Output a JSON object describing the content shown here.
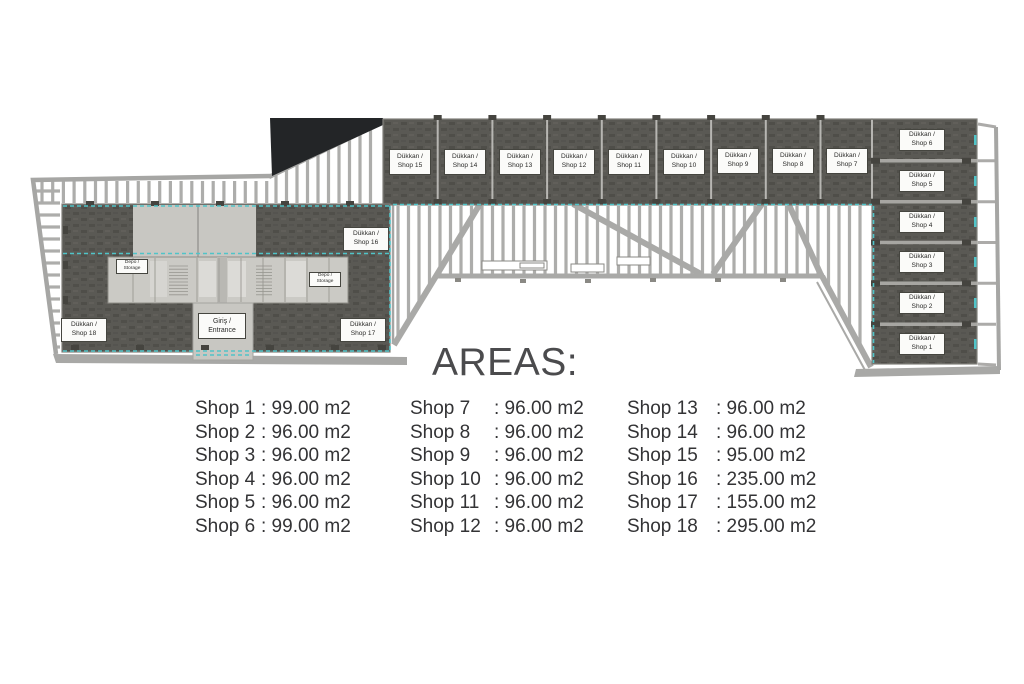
{
  "areas": {
    "title": "AREAS:",
    "separator": ":",
    "columns": [
      {
        "items": [
          {
            "name": "Shop 1",
            "value": "99.00 m2"
          },
          {
            "name": "Shop 2",
            "value": "96.00 m2"
          },
          {
            "name": "Shop 3",
            "value": "96.00 m2"
          },
          {
            "name": "Shop 4",
            "value": "96.00 m2"
          },
          {
            "name": "Shop 5",
            "value": "96.00 m2"
          },
          {
            "name": "Shop 6",
            "value": "99.00 m2"
          }
        ]
      },
      {
        "items": [
          {
            "name": "Shop 7",
            "value": "96.00 m2"
          },
          {
            "name": "Shop 8",
            "value": "96.00 m2"
          },
          {
            "name": "Shop 9",
            "value": "96.00 m2"
          },
          {
            "name": "Shop 10",
            "value": "96.00 m2"
          },
          {
            "name": "Shop 11",
            "value": "96.00 m2"
          },
          {
            "name": "Shop 12",
            "value": "96.00 m2"
          }
        ]
      },
      {
        "items": [
          {
            "name": "Shop 13",
            "value": "96.00 m2"
          },
          {
            "name": "Shop 14",
            "value": "96.00 m2"
          },
          {
            "name": "Shop 15",
            "value": "95.00 m2"
          },
          {
            "name": "Shop 16",
            "value": "235.00 m2"
          },
          {
            "name": "Shop 17",
            "value": "155.00 m2"
          },
          {
            "name": "Shop 18",
            "value": "295.00 m2"
          }
        ]
      }
    ]
  },
  "plan": {
    "labels": [
      {
        "id": "shop-15",
        "line1": "Dükkan /",
        "line2": "Shop 15",
        "x": 410,
        "y": 162,
        "w": 42,
        "h": 26,
        "kind": "shop"
      },
      {
        "id": "shop-14",
        "line1": "Dükkan /",
        "line2": "Shop 14",
        "x": 465,
        "y": 162,
        "w": 42,
        "h": 26,
        "kind": "shop"
      },
      {
        "id": "shop-13",
        "line1": "Dükkan /",
        "line2": "Shop 13",
        "x": 520,
        "y": 162,
        "w": 42,
        "h": 26,
        "kind": "shop"
      },
      {
        "id": "shop-12",
        "line1": "Dükkan /",
        "line2": "Shop 12",
        "x": 574,
        "y": 162,
        "w": 42,
        "h": 26,
        "kind": "shop"
      },
      {
        "id": "shop-11",
        "line1": "Dükkan /",
        "line2": "Shop 11",
        "x": 629,
        "y": 162,
        "w": 42,
        "h": 26,
        "kind": "shop"
      },
      {
        "id": "shop-10",
        "line1": "Dükkan /",
        "line2": "Shop 10",
        "x": 684,
        "y": 162,
        "w": 42,
        "h": 26,
        "kind": "shop"
      },
      {
        "id": "shop-9",
        "line1": "Dükkan /",
        "line2": "Shop 9",
        "x": 738,
        "y": 161,
        "w": 42,
        "h": 26,
        "kind": "shop"
      },
      {
        "id": "shop-8",
        "line1": "Dükkan /",
        "line2": "Shop 8",
        "x": 793,
        "y": 161,
        "w": 42,
        "h": 26,
        "kind": "shop"
      },
      {
        "id": "shop-7",
        "line1": "Dükkan /",
        "line2": "Shop 7",
        "x": 847,
        "y": 161,
        "w": 42,
        "h": 26,
        "kind": "shop"
      },
      {
        "id": "shop-6",
        "line1": "Dükkan /",
        "line2": "Shop 6",
        "x": 922,
        "y": 140,
        "w": 46,
        "h": 22,
        "kind": "shop"
      },
      {
        "id": "shop-5",
        "line1": "Dükkan /",
        "line2": "Shop 5",
        "x": 922,
        "y": 181,
        "w": 46,
        "h": 22,
        "kind": "shop"
      },
      {
        "id": "shop-4",
        "line1": "Dükkan /",
        "line2": "Shop 4",
        "x": 922,
        "y": 222,
        "w": 46,
        "h": 22,
        "kind": "shop"
      },
      {
        "id": "shop-3",
        "line1": "Dükkan /",
        "line2": "Shop 3",
        "x": 922,
        "y": 262,
        "w": 46,
        "h": 22,
        "kind": "shop"
      },
      {
        "id": "shop-2",
        "line1": "Dükkan /",
        "line2": "Shop 2",
        "x": 922,
        "y": 303,
        "w": 46,
        "h": 22,
        "kind": "shop"
      },
      {
        "id": "shop-1",
        "line1": "Dükkan /",
        "line2": "Shop 1",
        "x": 922,
        "y": 344,
        "w": 46,
        "h": 22,
        "kind": "shop"
      },
      {
        "id": "shop-16",
        "line1": "Dükkan /",
        "line2": "Shop 16",
        "x": 366,
        "y": 239,
        "w": 46,
        "h": 24,
        "kind": "shop"
      },
      {
        "id": "shop-17",
        "line1": "Dükkan /",
        "line2": "Shop 17",
        "x": 363,
        "y": 330,
        "w": 46,
        "h": 24,
        "kind": "shop"
      },
      {
        "id": "shop-18",
        "line1": "Dükkan /",
        "line2": "Shop 18",
        "x": 84,
        "y": 330,
        "w": 46,
        "h": 24,
        "kind": "shop"
      },
      {
        "id": "entrance",
        "line1": "Giriş /",
        "line2": "Entrance",
        "x": 222,
        "y": 326,
        "w": 48,
        "h": 26,
        "kind": "entrance"
      },
      {
        "id": "storage-left",
        "line1": "Depo /",
        "line2": "Storage",
        "x": 132,
        "y": 266,
        "w": 32,
        "h": 15,
        "kind": "small"
      },
      {
        "id": "storage-right",
        "line1": "Depo /",
        "line2": "Storage",
        "x": 325,
        "y": 279,
        "w": 32,
        "h": 15,
        "kind": "small"
      }
    ],
    "colors": {
      "shop_fill": "#5a5954",
      "interior_light": "#c8c7c2",
      "railing": "#a6a6a4",
      "accent_teal": "#50c4c8",
      "black_area": "#232527",
      "text_dark": "#333335"
    }
  }
}
